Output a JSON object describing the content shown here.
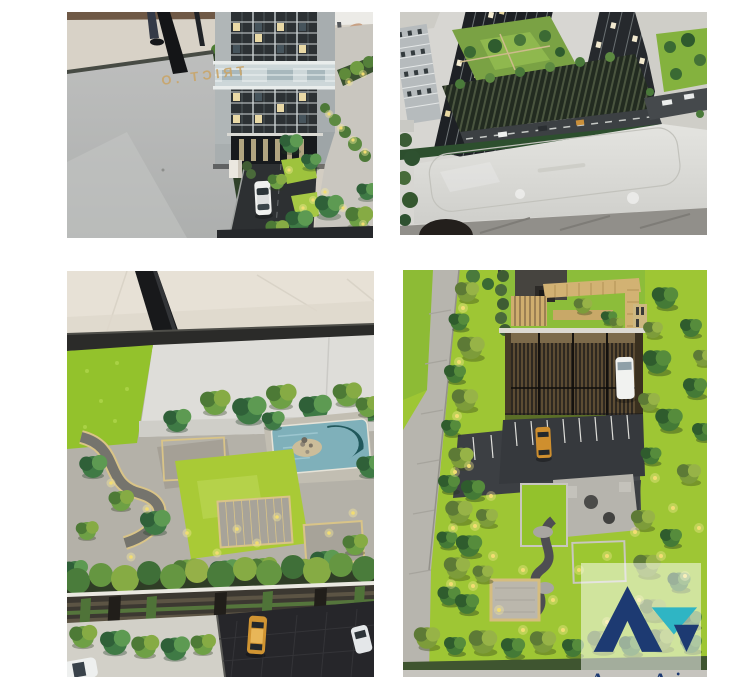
{
  "brand": {
    "watermark_text": "Accom Asia",
    "navy": "#1d3a72",
    "teal": "#2fb5c4",
    "box_opacity": "0.52"
  },
  "photos": {
    "top_left": {
      "road_text": "TRICT .O"
    }
  },
  "palette": {
    "page_background": "#ffffff",
    "lawn_green": "#9ec634",
    "model_marble": "#d9d9d5",
    "asphalt": "#3f4246",
    "pool_water": "#7fb0ba",
    "pool_deep": "#20575b",
    "warm_light": "#f2dd72"
  }
}
